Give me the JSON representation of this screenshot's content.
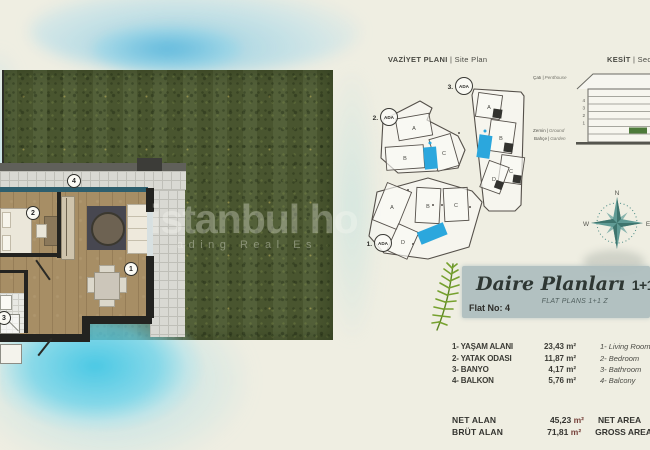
{
  "colors": {
    "pool_blue": "#2ba7dd",
    "grass_green": "#4d5a32",
    "compass_teal": "#5f9a94",
    "banner_bg": "#adbdbe",
    "section_ground_green": "#4d7a3a",
    "cyan_wash": "#46c7e4",
    "unit_red": "#76413a"
  },
  "watermark": {
    "line1": "istanbul ho",
    "line2": "ading Real Es"
  },
  "titles": {
    "site_plan_tr": "VAZİYET PLANI",
    "separator": "|",
    "site_plan_en": "Site Plan",
    "section_tr": "KESİT",
    "section_en": "Section"
  },
  "site_plan": {
    "ada1": {
      "num": "1.",
      "name": "ADA"
    },
    "ada2": {
      "num": "2.",
      "name": "ADA"
    },
    "ada3": {
      "num": "3.",
      "name": "ADA"
    },
    "block1_buildings": [
      "A",
      "B",
      "C",
      "D"
    ],
    "block2_buildings": [
      "A",
      "B",
      "C"
    ],
    "block3_buildings": [
      "A",
      "B",
      "C",
      "D"
    ]
  },
  "section": {
    "roof_tr": "Çatı",
    "roof_en": "Penthouse",
    "ground_tr": "Zemin",
    "ground_en": "Ground",
    "garden_tr": "Bahçe",
    "garden_en": "Garden",
    "floor_numbers": [
      "4",
      "3",
      "2",
      "1"
    ]
  },
  "compass": {
    "north": "N",
    "west": "W",
    "east": "E"
  },
  "banner": {
    "title_script": "Daire Planları",
    "title_suffix": "1+1 Z",
    "subtitle": "FLAT PLANS 1+1 Z",
    "flat_no": "Flat No: 4"
  },
  "plan_markers": {
    "living": "1",
    "bedroom": "2",
    "bath": "3",
    "balcony": "4"
  },
  "room_list": [
    {
      "tr": "1- YAŞAM ALANI",
      "value": "23,43 m²",
      "en": "1- Living Room"
    },
    {
      "tr": "2- YATAK ODASI",
      "value": "11,87 m²",
      "en": "2- Bedroom"
    },
    {
      "tr": "3- BANYO",
      "value": "4,17 m²",
      "en": "3- Bathroom"
    },
    {
      "tr": "4- BALKON",
      "value": "5,76 m²",
      "en": "4- Balcony"
    }
  ],
  "totals": [
    {
      "tr": "NET ALAN",
      "value": "45,23",
      "unit": "m²",
      "en": "NET AREA"
    },
    {
      "tr": "BRÜT ALAN",
      "value": "71,81",
      "unit": "m²",
      "en": "GROSS AREA"
    }
  ]
}
